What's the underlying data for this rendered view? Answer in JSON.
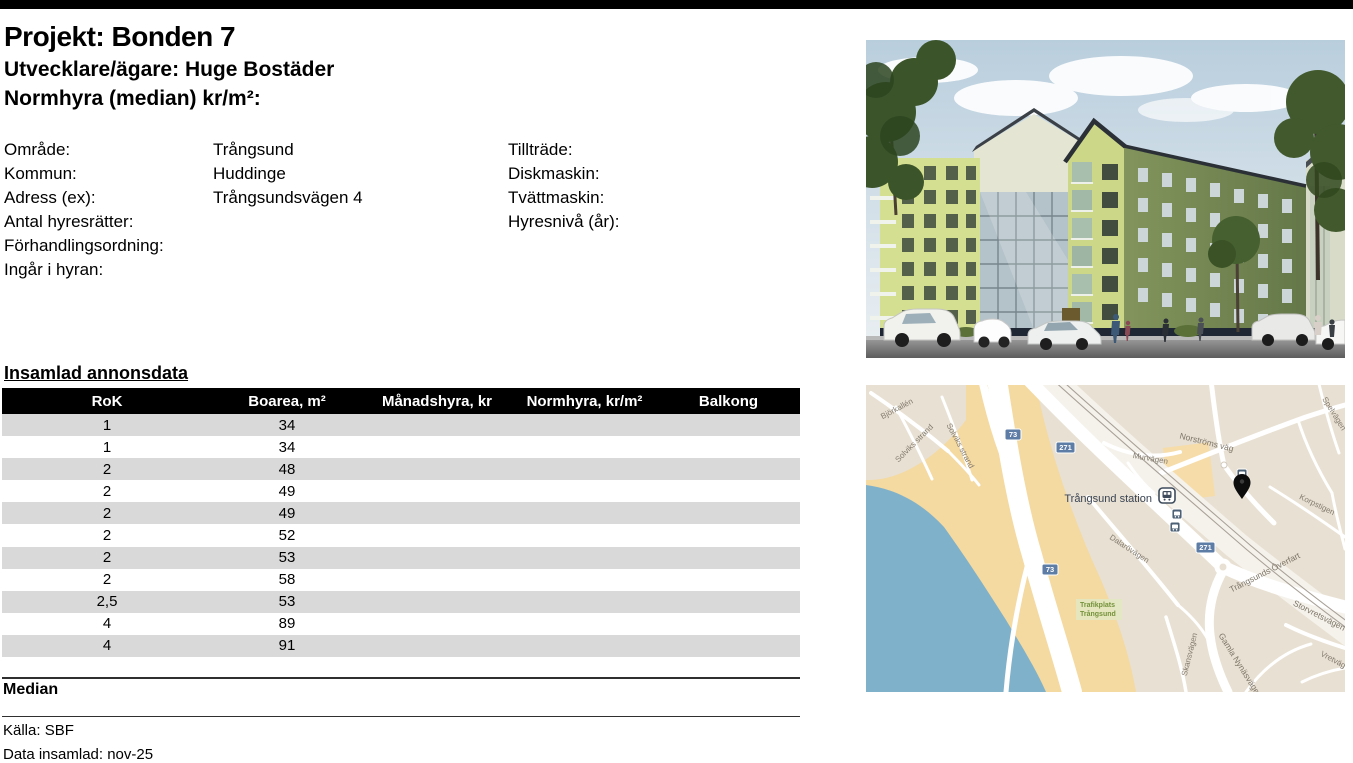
{
  "header": {
    "title": "Projekt: Bonden 7",
    "developer": "Utvecklare/ägare: Huge Bostäder",
    "normhyra": "Normhyra (median) kr/m²:"
  },
  "info": {
    "left": [
      {
        "label": "Område:",
        "value": "Trångsund"
      },
      {
        "label": "Kommun:",
        "value": "Huddinge"
      },
      {
        "label": "Adress (ex):",
        "value": "Trångsundsvägen 4"
      },
      {
        "label": "Antal hyresrätter:",
        "value": ""
      },
      {
        "label": "Förhandlingsordning:",
        "value": ""
      },
      {
        "label": "Ingår i hyran:",
        "value": ""
      }
    ],
    "right": [
      {
        "label": "Tillträde:",
        "value": ""
      },
      {
        "label": "Diskmaskin:",
        "value": ""
      },
      {
        "label": "Tvättmaskin:",
        "value": ""
      },
      {
        "label": "Hyresnivå (år):",
        "value": ""
      }
    ]
  },
  "table": {
    "section_title": "Insamlad annonsdata",
    "headers": [
      "RoK",
      "Boarea, m²",
      "Månadshyra, kr",
      "Normhyra, kr/m²",
      "Balkong"
    ],
    "rows": [
      [
        "1",
        "34",
        "",
        "",
        ""
      ],
      [
        "1",
        "34",
        "",
        "",
        ""
      ],
      [
        "2",
        "48",
        "",
        "",
        ""
      ],
      [
        "2",
        "49",
        "",
        "",
        ""
      ],
      [
        "2",
        "49",
        "",
        "",
        ""
      ],
      [
        "2",
        "52",
        "",
        "",
        ""
      ],
      [
        "2",
        "53",
        "",
        "",
        ""
      ],
      [
        "2",
        "58",
        "",
        "",
        ""
      ],
      [
        "2,5",
        "53",
        "",
        "",
        ""
      ],
      [
        "4",
        "89",
        "",
        "",
        ""
      ],
      [
        "4",
        "91",
        "",
        "",
        ""
      ]
    ]
  },
  "summary": {
    "median_label": "Median"
  },
  "footer": {
    "source": "Källa: SBF",
    "collected": "Data insamlad: nov-25"
  },
  "colors": {
    "row_stripe": "#d9d9d9",
    "table_header_bg": "#000000",
    "map_water": "#7fb2ca",
    "map_sand": "#f4d9a1",
    "map_land": "#e8e0d2",
    "route_badge": "#5d7ca6"
  },
  "map": {
    "station_label": "Trångsund station",
    "area_label": {
      "line1": "Trafikplats",
      "line2": "Trångsund"
    },
    "streets": {
      "bjorkallen": "Björkallén",
      "solviks_strand_1": "Solviks strand",
      "solviks_strand_2": "Solviks strand",
      "murvagen": "Murvägen",
      "norstroms_vag": "Norströms väg",
      "spelvagen": "Spelvägen",
      "korpstigen": "Korpstigen",
      "dalarovagen": "Dalarövägen",
      "trangsunds_overfart": "Trångsunds Överfart",
      "storvretsvagen": "Storvretsvägen",
      "gamla_nynasvagen": "Gamla Nynäsvägen",
      "skansvagen": "Skansvägen",
      "vretvagen": "Vretvägen"
    },
    "route_badges": {
      "r73": "73",
      "r271": "271"
    }
  }
}
